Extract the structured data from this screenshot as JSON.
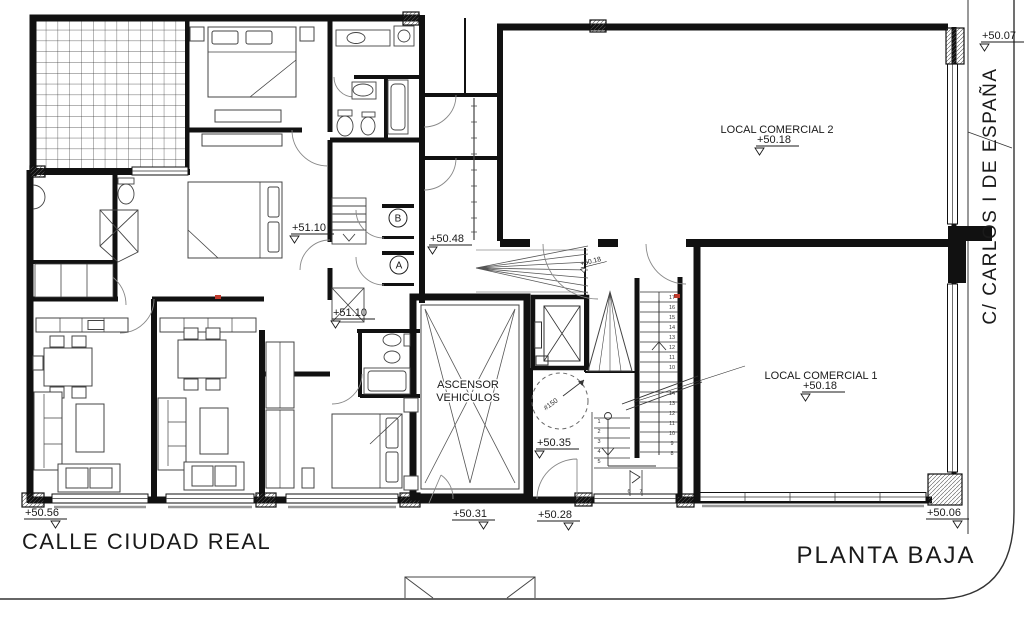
{
  "sheet": {
    "title": "PLANTA BAJA",
    "street_bottom": "CALLE CIUDAD REAL",
    "street_right": "C/ CARLOS I DE ESPAÑA"
  },
  "rooms": {
    "local_comercial_2": "LOCAL COMERCIAL 2",
    "local_comercial_1": "LOCAL COMERCIAL 1",
    "ascensor_line1": "ASCENSOR",
    "ascensor_line2": "VEHICULOS"
  },
  "annotations": {
    "core_b": "B",
    "core_a": "A",
    "shaft_diameter": "#150"
  },
  "elevation_markers": [
    {
      "label": "+50.07",
      "x": 982,
      "y": 39,
      "tri": "l"
    },
    {
      "label": "+50.18",
      "x": 757,
      "y": 143,
      "tri": "l"
    },
    {
      "label": "+51.10",
      "x": 292,
      "y": 231,
      "tri": "l"
    },
    {
      "label": "+50.48",
      "x": 430,
      "y": 242,
      "tri": "l"
    },
    {
      "label": "+51.10",
      "x": 333,
      "y": 316,
      "tri": "l"
    },
    {
      "label": "+50.18",
      "x": 581,
      "y": 266,
      "tri": "l",
      "rot": -14,
      "scale": 0.62
    },
    {
      "label": "+50.35",
      "x": 537,
      "y": 446,
      "tri": "l"
    },
    {
      "label": "+50.18",
      "x": 803,
      "y": 389,
      "tri": "l"
    },
    {
      "label": "+50.31",
      "x": 453,
      "y": 517,
      "tri": "r"
    },
    {
      "label": "+50.28",
      "x": 538,
      "y": 518,
      "tri": "r"
    },
    {
      "label": "+50.56",
      "x": 25,
      "y": 516,
      "tri": "r"
    },
    {
      "label": "+50.06",
      "x": 927,
      "y": 516,
      "tri": "r"
    }
  ],
  "stair_step_numbers": {
    "upper_run": [
      "17",
      "16",
      "15",
      "14",
      "13",
      "12",
      "11",
      "10"
    ],
    "lower_run": [
      "14",
      "13",
      "12",
      "11",
      "10",
      "9",
      "8"
    ],
    "entry_run": [
      "1",
      "2",
      "3",
      "4",
      "5"
    ],
    "landing_run": [
      "6",
      "7"
    ]
  }
}
